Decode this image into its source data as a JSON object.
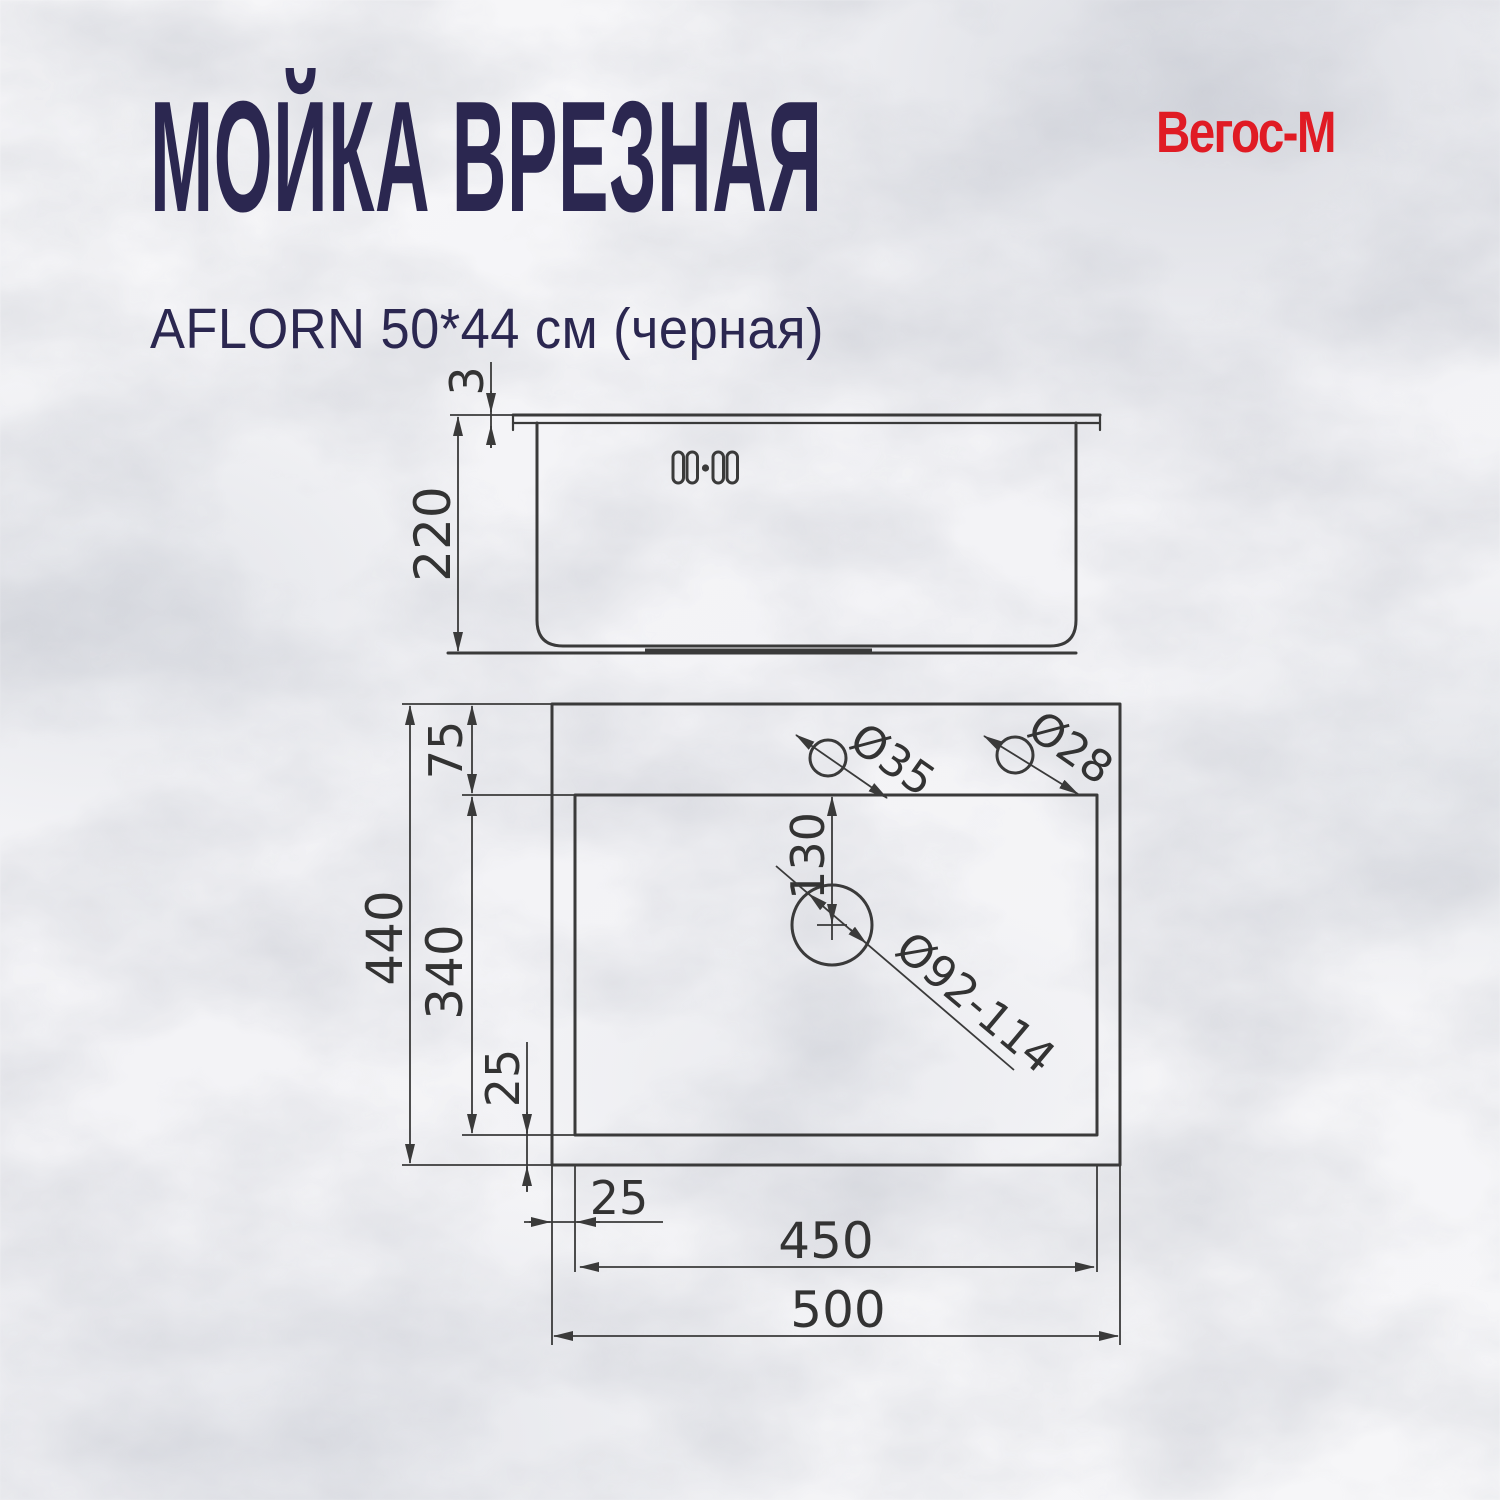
{
  "header": {
    "title": "МОЙКА ВРЕЗНАЯ",
    "subtitle": "AFLORN 50*44 см (черная)",
    "brand": "Вегос-М",
    "title_color": "#2b2750",
    "brand_color": "#e01b24"
  },
  "drawing": {
    "line_color": "#3a3a3a",
    "side": {
      "rim_thickness": "3",
      "depth": "220"
    },
    "top": {
      "top_offset": "75",
      "outer_height": "440",
      "inner_height": "340",
      "bottom_offset": "25",
      "left_offset": "25",
      "inner_width": "450",
      "outer_width": "500",
      "drain_offset": "130",
      "faucet_hole": "Ø35",
      "aux_hole": "Ø28",
      "drain_hole": "Ø92-114"
    }
  }
}
